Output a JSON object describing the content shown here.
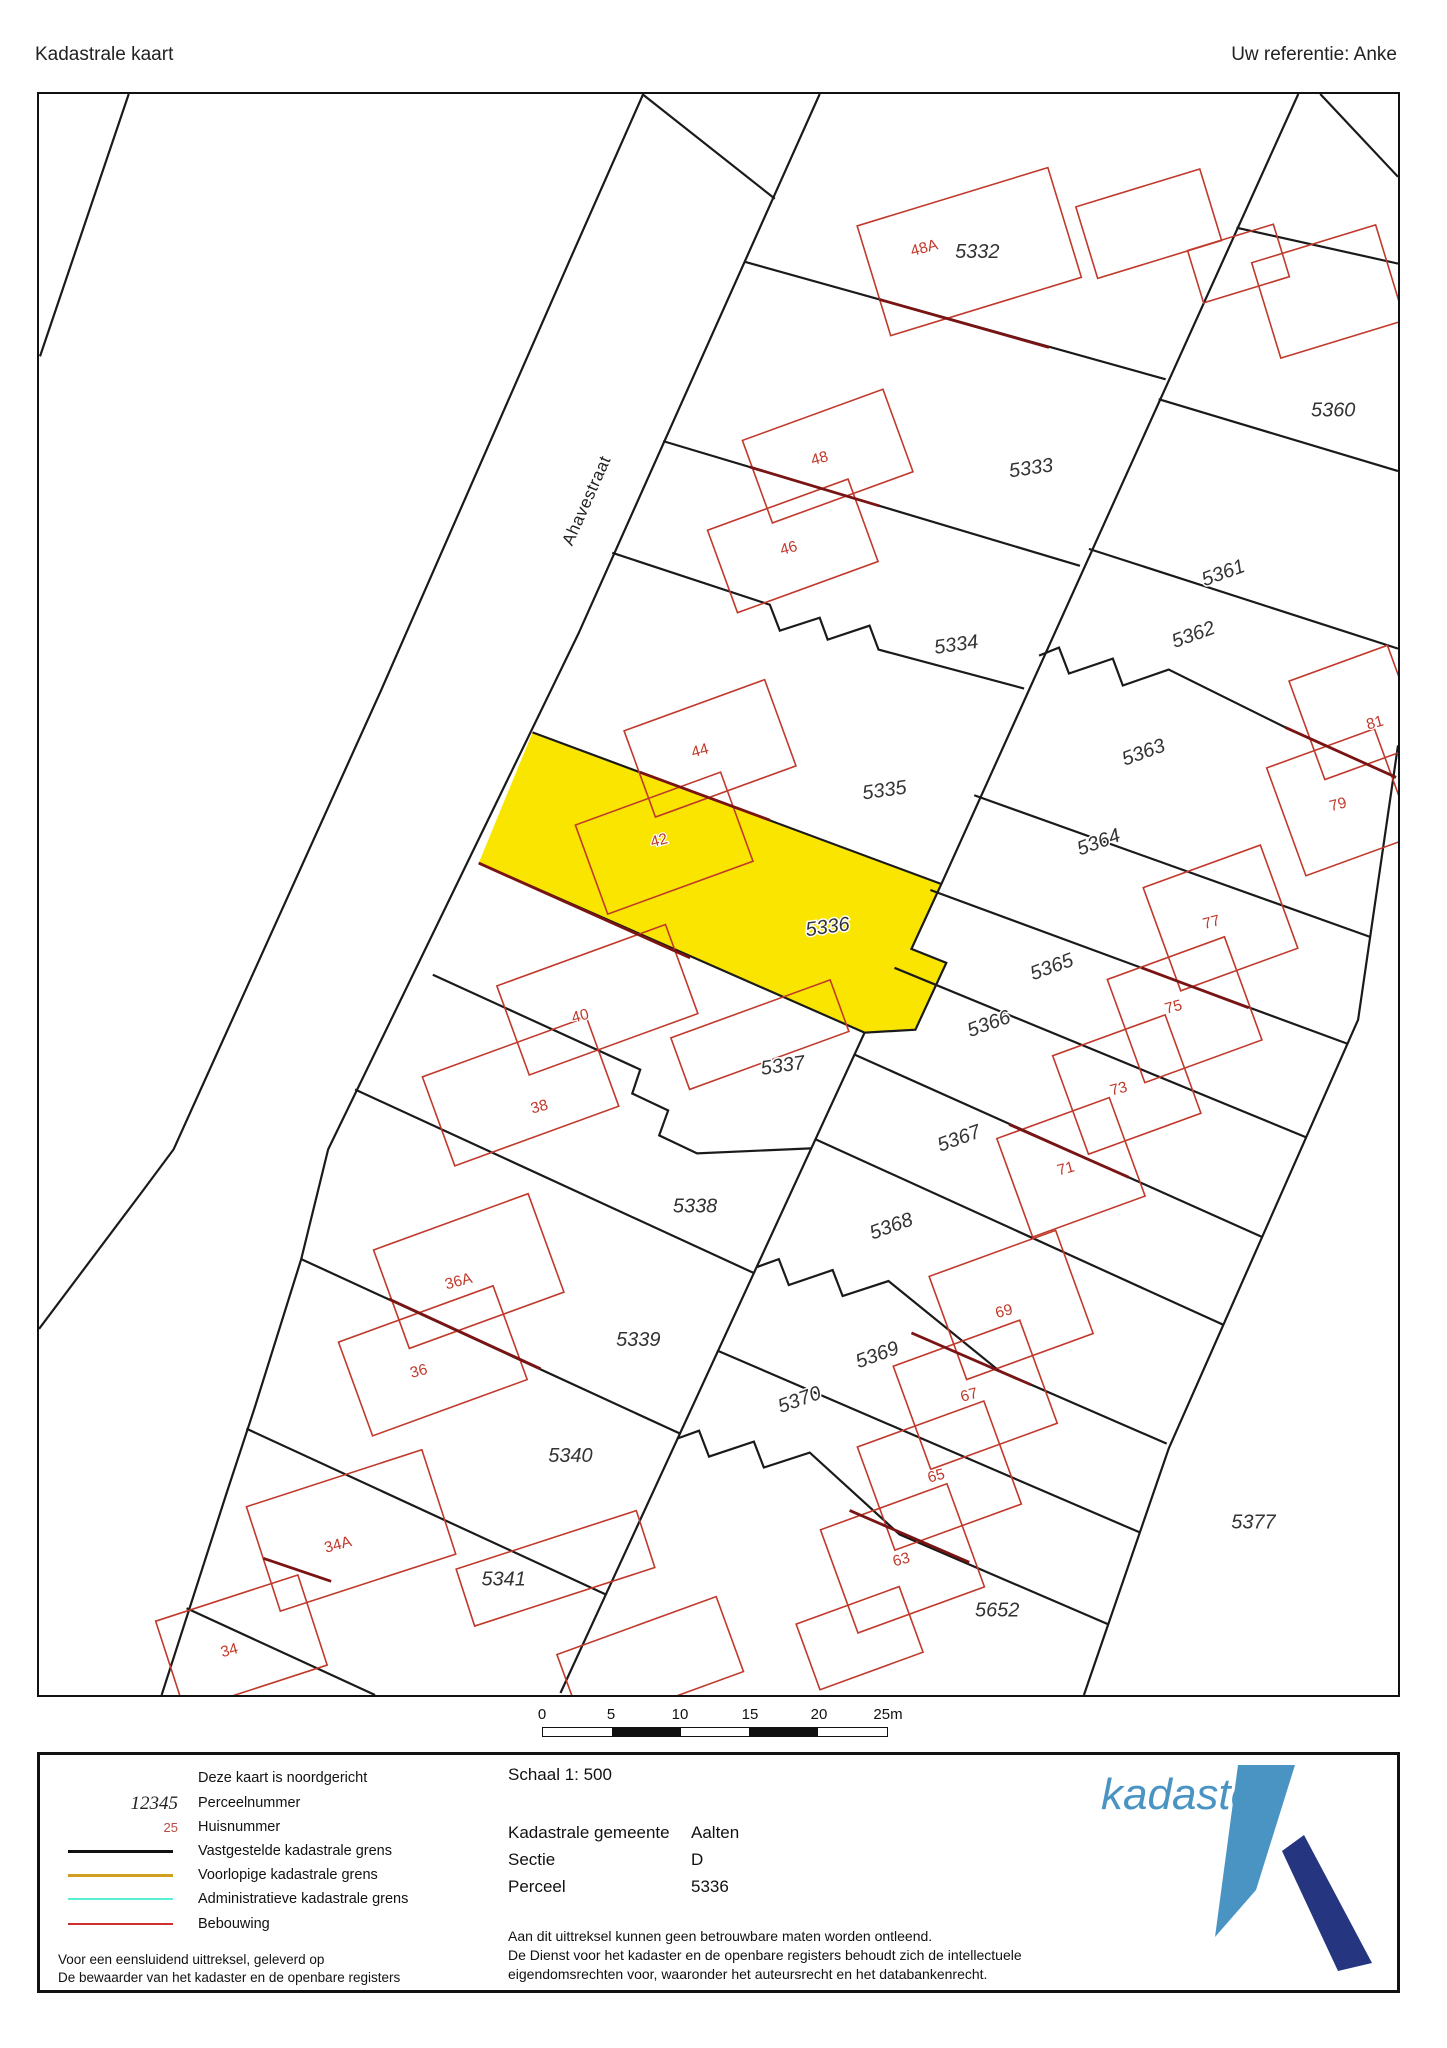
{
  "header": {
    "title": "Kadastrale kaart",
    "reference": "Uw referentie: Anke"
  },
  "map": {
    "street_label": "Ahavestraat",
    "highlight": {
      "parcel": "5336",
      "color": "#f9e500"
    },
    "parcel_labels": [
      {
        "text": "5332",
        "x": 978,
        "y": 251,
        "r": 0
      },
      {
        "text": "5333",
        "x": 1032,
        "y": 468,
        "r": -8
      },
      {
        "text": "5334",
        "x": 957,
        "y": 645,
        "r": -8
      },
      {
        "text": "5335",
        "x": 885,
        "y": 791,
        "r": -8
      },
      {
        "text": "5336",
        "x": 828,
        "y": 928,
        "r": -8
      },
      {
        "text": "5337",
        "x": 783,
        "y": 1067,
        "r": -8
      },
      {
        "text": "5338",
        "x": 695,
        "y": 1208,
        "r": 0
      },
      {
        "text": "5339",
        "x": 638,
        "y": 1342,
        "r": 0
      },
      {
        "text": "5340",
        "x": 570,
        "y": 1458,
        "r": 0
      },
      {
        "text": "5341",
        "x": 503,
        "y": 1582,
        "r": 0
      },
      {
        "text": "5360",
        "x": 1335,
        "y": 410,
        "r": 0
      },
      {
        "text": "5361",
        "x": 1225,
        "y": 573,
        "r": -20
      },
      {
        "text": "5362",
        "x": 1195,
        "y": 635,
        "r": -20
      },
      {
        "text": "5363",
        "x": 1145,
        "y": 753,
        "r": -20
      },
      {
        "text": "5364",
        "x": 1100,
        "y": 843,
        "r": -20
      },
      {
        "text": "5365",
        "x": 1053,
        "y": 968,
        "r": -20
      },
      {
        "text": "5366",
        "x": 990,
        "y": 1025,
        "r": -20
      },
      {
        "text": "5367",
        "x": 960,
        "y": 1140,
        "r": -20
      },
      {
        "text": "5368",
        "x": 892,
        "y": 1228,
        "r": -20
      },
      {
        "text": "5369",
        "x": 878,
        "y": 1357,
        "r": -20
      },
      {
        "text": "5370",
        "x": 800,
        "y": 1402,
        "r": -20
      },
      {
        "text": "5652",
        "x": 998,
        "y": 1613,
        "r": 0
      },
      {
        "text": "5377",
        "x": 1255,
        "y": 1525,
        "r": 0
      }
    ],
    "house_labels": [
      {
        "text": "48A",
        "x": 925,
        "y": 247,
        "r": -15
      },
      {
        "text": "48",
        "x": 820,
        "y": 458,
        "r": -15
      },
      {
        "text": "46",
        "x": 789,
        "y": 548,
        "r": -15
      },
      {
        "text": "44",
        "x": 700,
        "y": 751,
        "r": -15
      },
      {
        "text": "42",
        "x": 659,
        "y": 841,
        "r": -15
      },
      {
        "text": "40",
        "x": 580,
        "y": 1017,
        "r": -15
      },
      {
        "text": "38",
        "x": 539,
        "y": 1108,
        "r": -15
      },
      {
        "text": "36A",
        "x": 458,
        "y": 1283,
        "r": -15
      },
      {
        "text": "36",
        "x": 418,
        "y": 1373,
        "r": -15
      },
      {
        "text": "34A",
        "x": 337,
        "y": 1547,
        "r": -15
      },
      {
        "text": "34",
        "x": 228,
        "y": 1653,
        "r": -15
      },
      {
        "text": "81",
        "x": 1377,
        "y": 723,
        "r": -15
      },
      {
        "text": "79",
        "x": 1340,
        "y": 805,
        "r": -15
      },
      {
        "text": "77",
        "x": 1213,
        "y": 923,
        "r": -15
      },
      {
        "text": "75",
        "x": 1175,
        "y": 1008,
        "r": -15
      },
      {
        "text": "73",
        "x": 1120,
        "y": 1090,
        "r": -15
      },
      {
        "text": "71",
        "x": 1067,
        "y": 1170,
        "r": -15
      },
      {
        "text": "69",
        "x": 1005,
        "y": 1313,
        "r": -15
      },
      {
        "text": "67",
        "x": 970,
        "y": 1397,
        "r": -15
      },
      {
        "text": "65",
        "x": 937,
        "y": 1478,
        "r": -15
      },
      {
        "text": "63",
        "x": 902,
        "y": 1562,
        "r": -15
      }
    ]
  },
  "scalebar": {
    "ticks": [
      "0",
      "5",
      "10",
      "15",
      "20",
      "25m"
    ]
  },
  "legend": {
    "north_note": "Deze kaart is noordgericht",
    "items": [
      {
        "sample": "12345",
        "label": "Perceelnummer"
      },
      {
        "sample": "25",
        "label": "Huisnummer"
      },
      {
        "color": "#111111",
        "label": "Vastgestelde kadastrale grens"
      },
      {
        "color": "#d19f1f",
        "label": "Voorlopige kadastrale grens"
      },
      {
        "color": "#5af0d5",
        "label": "Administratieve kadastrale grens"
      },
      {
        "color": "#cf2f2f",
        "label": "Bebouwing"
      }
    ],
    "footnote1": "Voor een eensluidend uittreksel, geleverd op",
    "footnote2": "De bewaarder van het kadaster en de openbare registers"
  },
  "details": {
    "schaal": "Schaal 1: 500",
    "rows": [
      {
        "label": "Kadastrale gemeente",
        "value": "Aalten"
      },
      {
        "label": "Sectie",
        "value": "D"
      },
      {
        "label": "Perceel",
        "value": "5336"
      }
    ],
    "disclaimer": [
      "Aan dit uittreksel kunnen geen betrouwbare maten worden ontleend.",
      "De Dienst voor het kadaster en de openbare registers behoudt zich de intellectuele",
      "eigendomsrechten voor, waaronder het auteursrecht en het databankenrecht."
    ]
  },
  "logo": {
    "text": "kadaster",
    "light": "#4a94c4",
    "dark": "#26357f"
  }
}
